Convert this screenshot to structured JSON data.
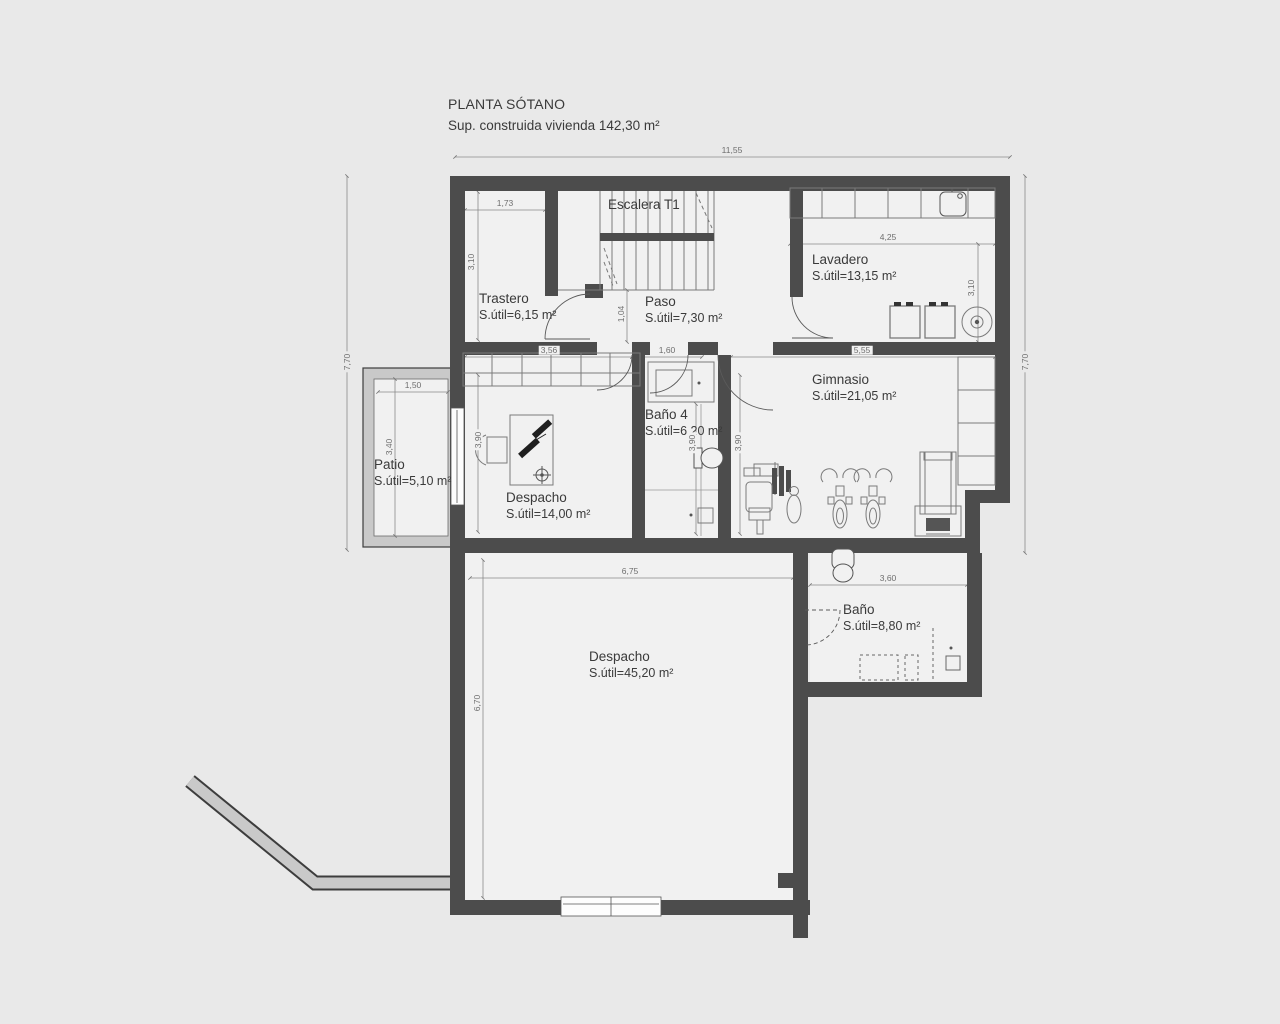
{
  "title": "PLANTA SÓTANO",
  "subtitle": "Sup. construida vivienda 142,30 m²",
  "stair": {
    "label": "Escalera T1"
  },
  "rooms": {
    "trastero": {
      "name": "Trastero",
      "area": "S.útil=6,15 m²"
    },
    "paso": {
      "name": "Paso",
      "area": "S.útil=7,30 m²"
    },
    "lavadero": {
      "name": "Lavadero",
      "area": "S.útil=13,15 m²"
    },
    "bano4": {
      "name": "Baño 4",
      "area": "S.útil=6,20 m²"
    },
    "gimnasio": {
      "name": "Gimnasio",
      "area": "S.útil=21,05 m²"
    },
    "patio": {
      "name": "Patio",
      "area": "S.útil=5,10 m²"
    },
    "despacho1": {
      "name": "Despacho",
      "area": "S.útil=14,00 m²"
    },
    "despacho2": {
      "name": "Despacho",
      "area": "S.útil=45,20 m²"
    },
    "bano": {
      "name": "Baño",
      "area": "S.útil=8,80 m²"
    }
  },
  "dimensions": {
    "overall_width": "11,55",
    "left_height": "7,70",
    "right_height": "7,70",
    "trastero_width": "1,73",
    "trastero_height": "3,10",
    "lavadero_width": "4,25",
    "lavadero_height": "3,10",
    "despacho1_width": "3,56",
    "bano4_width": "1,60",
    "gimnasio_width": "5,55",
    "paso_height": "1,04",
    "patio_width": "1,50",
    "patio_height": "3,40",
    "despacho1_height": "3,90",
    "bano4_height": "3,90",
    "gimnasio_height": "3,90",
    "despacho2_width": "6,75",
    "despacho2_height": "6,70",
    "bano_width": "3,60"
  },
  "colors": {
    "wall": "#4c4c4c",
    "light_wall": "#c9c9c9",
    "floor": "#f1f1f1",
    "background": "#e9e9e9",
    "dim_line": "#8a8a8a",
    "text": "#3a3a3a"
  }
}
